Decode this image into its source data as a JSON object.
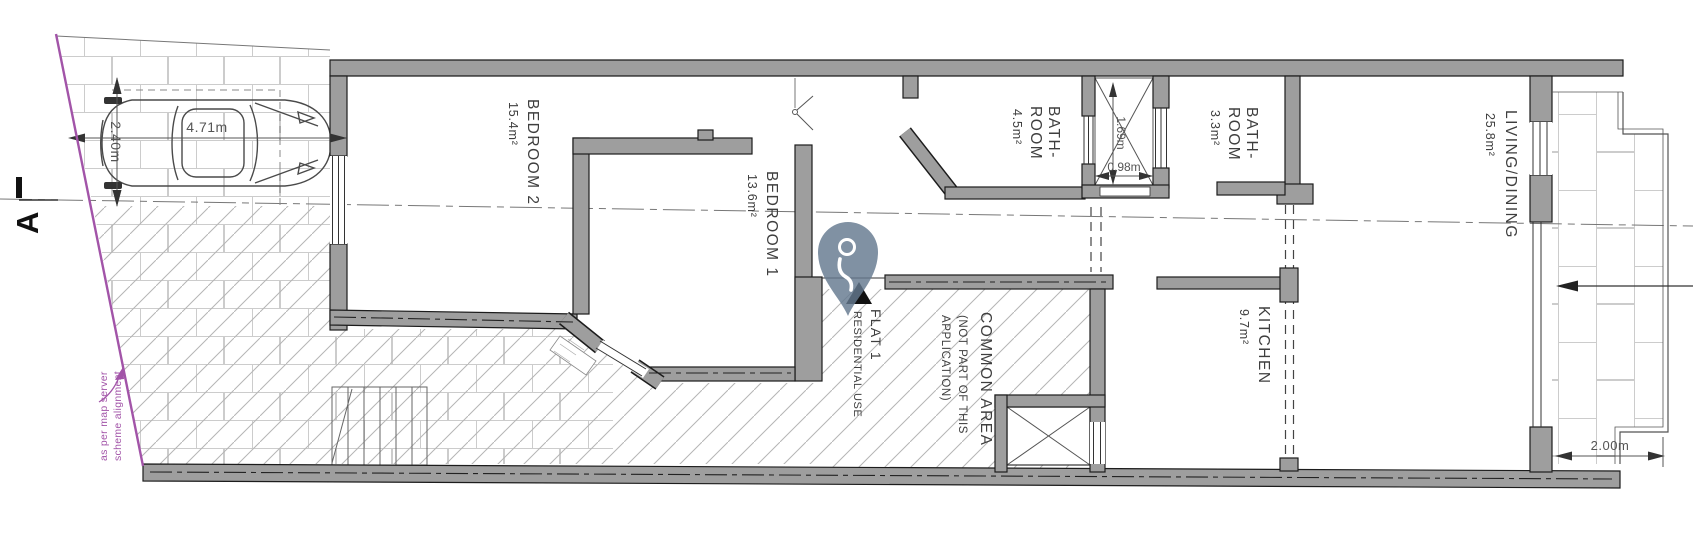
{
  "title": "Flat 1 floor plan",
  "rooms": {
    "bedroom2": {
      "label": "BEDROOM 2",
      "area": "15.4m²"
    },
    "bedroom1": {
      "label": "BEDROOM 1",
      "area": "13.6m²"
    },
    "bathroom1": {
      "label_line1": "BATH-",
      "label_line2": "ROOM",
      "area": "4.5m²"
    },
    "bathroom2": {
      "label_line1": "BATH-",
      "label_line2": "ROOM",
      "area": "3.3m²"
    },
    "living_dining": {
      "label": "LIVING/DINING",
      "area": "25.8m²"
    },
    "kitchen": {
      "label": "KITCHEN",
      "area": "9.7m²"
    },
    "common_area": {
      "label": "COMMON AREA",
      "note_line1": "(NOT PART OF THIS",
      "note_line2": "APPLICATION)"
    },
    "flat1": {
      "label": "FLAT 1",
      "sublabel": "RESIDENTIAL USE"
    }
  },
  "dimensions": {
    "parking_length": "4.71m",
    "parking_width": "2.40m",
    "shaft_depth": "1.69m",
    "shaft_width": "0.98m",
    "balcony_width": "2.00m"
  },
  "annotations": {
    "section_marker": "A",
    "boundary_note_line1": "scheme alignment",
    "boundary_note_line2": "as per map server"
  },
  "icons": {
    "location_pin": "location-pin"
  },
  "colors": {
    "wall": "#9e9e9e",
    "wall_edge": "#1c1c1c",
    "boundary_line": "#a254a8",
    "pin": "#64798f",
    "hatch": "#b5b5b5",
    "tile": "#cccccc",
    "text": "#3e3e3e",
    "dimension_text": "#555555"
  }
}
